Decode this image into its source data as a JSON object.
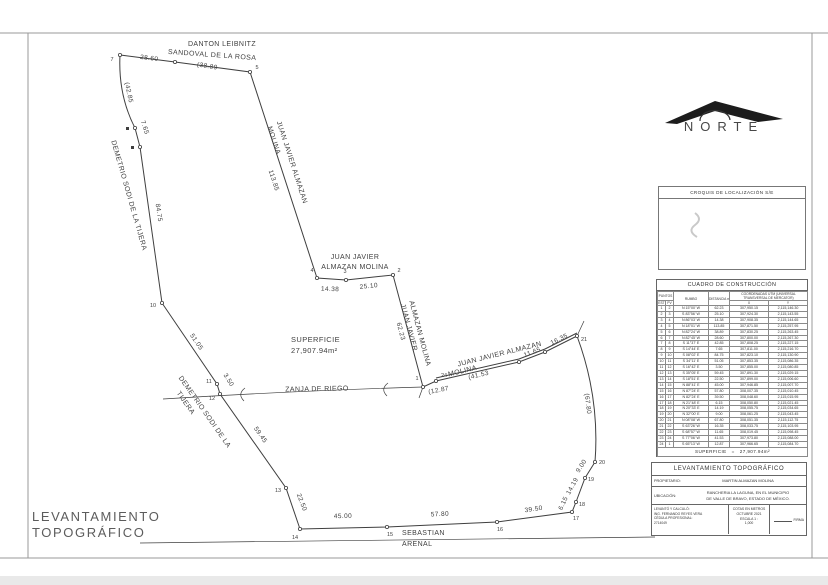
{
  "sheet_title": {
    "line1": "LEVANTAMIENTO",
    "line2": "TOPOGRÁFICO"
  },
  "north": {
    "label": "NORTE"
  },
  "croquis": {
    "title": "CROQUIS DE LOCALIZACIÓN S/E"
  },
  "drawing": {
    "superficie_label": "SUPERFICIE",
    "superficie_value": "27,907.94m²",
    "paths": [
      {
        "name": "parcel-boundary",
        "d": "M423 387 L393 275 L346 280 L317 278 L250 72 L175 62 L120 55 Q118 95 135 128 L140 147 L162 303 L217 384 L220 394 L286 488 L300 529 L387 527 L497 522 L572 512 L576 502 L585 478 L595 462 Q600 398 577 336 L545 352 L519 362 L436 381 Z",
        "w": 1
      },
      {
        "name": "boundary-double-line",
        "d": "M436 378 L519 359 L545 349 L577 333",
        "w": 1
      },
      {
        "name": "zanja-line",
        "d": "M163 399 Q290 391 423 387",
        "w": 0.7
      },
      {
        "name": "road-line",
        "d": "M140 543 L655 537",
        "w": 0.7
      },
      {
        "name": "corner-tick",
        "d": "M577 336 L584 321",
        "w": 0.7
      },
      {
        "name": "zanja-arc-mark",
        "d": "M245 388 Q237 394 244 401",
        "w": 0.7
      },
      {
        "name": "zanja-arc-mark",
        "d": "M388 383 Q380 389 387 396",
        "w": 0.7
      },
      {
        "name": "junction-tick",
        "d": "M423 387 L419 398",
        "w": 0.7
      }
    ],
    "points": [
      {
        "n": "1",
        "x": 423,
        "y": 387,
        "lx": 417,
        "ly": 380
      },
      {
        "n": "2",
        "x": 393,
        "y": 275,
        "lx": 399,
        "ly": 272
      },
      {
        "n": "3",
        "x": 346,
        "y": 280,
        "lx": 345,
        "ly": 273
      },
      {
        "n": "4",
        "x": 317,
        "y": 278,
        "lx": 312,
        "ly": 272
      },
      {
        "n": "5",
        "x": 250,
        "y": 72,
        "lx": 257,
        "ly": 69
      },
      {
        "n": "",
        "x": 175,
        "y": 62
      },
      {
        "n": "7",
        "x": 120,
        "y": 55,
        "lx": 112,
        "ly": 61
      },
      {
        "n": "",
        "x": 135,
        "y": 128,
        "sq": 1
      },
      {
        "n": "",
        "x": 140,
        "y": 147,
        "sq": 1
      },
      {
        "n": "10",
        "x": 162,
        "y": 303,
        "lx": 153,
        "ly": 307
      },
      {
        "n": "11",
        "x": 217,
        "y": 384,
        "lx": 209,
        "ly": 383
      },
      {
        "n": "12",
        "x": 220,
        "y": 394,
        "lx": 212,
        "ly": 400
      },
      {
        "n": "13",
        "x": 286,
        "y": 488,
        "lx": 278,
        "ly": 492
      },
      {
        "n": "14",
        "x": 300,
        "y": 529,
        "lx": 295,
        "ly": 539
      },
      {
        "n": "15",
        "x": 387,
        "y": 527,
        "lx": 390,
        "ly": 536
      },
      {
        "n": "16",
        "x": 497,
        "y": 522,
        "lx": 500,
        "ly": 531
      },
      {
        "n": "17",
        "x": 572,
        "y": 512,
        "lx": 576,
        "ly": 520
      },
      {
        "n": "18",
        "x": 576,
        "y": 502,
        "lx": 582,
        "ly": 506
      },
      {
        "n": "19",
        "x": 585,
        "y": 478,
        "lx": 591,
        "ly": 481
      },
      {
        "n": "20",
        "x": 595,
        "y": 462,
        "lx": 602,
        "ly": 464
      },
      {
        "n": "21",
        "x": 577,
        "y": 336,
        "lx": 584,
        "ly": 341
      },
      {
        "n": "",
        "x": 545,
        "y": 352
      },
      {
        "n": "",
        "x": 519,
        "y": 362
      },
      {
        "n": "24",
        "x": 436,
        "y": 381,
        "lx": 444,
        "ly": 377
      }
    ],
    "labels": [
      {
        "t": "62.23",
        "x": 399,
        "y": 332,
        "r": 75,
        "fs": 6.5
      },
      {
        "t": "25.10",
        "x": 369,
        "y": 288,
        "r": -6,
        "fs": 6.5
      },
      {
        "t": "14.38",
        "x": 330,
        "y": 291,
        "r": 2,
        "fs": 6.5
      },
      {
        "t": "113.85",
        "x": 272,
        "y": 181,
        "r": 72,
        "fs": 6.5
      },
      {
        "t": "(38.89",
        "x": 207,
        "y": 68,
        "r": 9,
        "fs": 6.5
      },
      {
        "t": "28.60",
        "x": 149,
        "y": 60,
        "r": 7,
        "fs": 6.5
      },
      {
        "t": "(42.85",
        "x": 127,
        "y": 93,
        "r": 78,
        "fs": 6.5
      },
      {
        "t": "7.65",
        "x": 143,
        "y": 128,
        "r": 72,
        "fs": 6.5
      },
      {
        "t": "84.75",
        "x": 157,
        "y": 213,
        "r": 81,
        "fs": 6.5
      },
      {
        "t": "51.05",
        "x": 195,
        "y": 343,
        "r": 56,
        "fs": 6.5
      },
      {
        "t": "3.50",
        "x": 227,
        "y": 381,
        "r": 58,
        "fs": 6.5
      },
      {
        "t": "59.45",
        "x": 259,
        "y": 436,
        "r": 55,
        "fs": 6.5
      },
      {
        "t": "22.50",
        "x": 300,
        "y": 503,
        "r": 69,
        "fs": 6.5
      },
      {
        "t": "45.00",
        "x": 343,
        "y": 518,
        "r": -1,
        "fs": 6.5
      },
      {
        "t": "57.80",
        "x": 440,
        "y": 516,
        "r": -3,
        "fs": 6.5
      },
      {
        "t": "39.50",
        "x": 534,
        "y": 511,
        "r": -9,
        "fs": 6.5
      },
      {
        "t": "6.15",
        "x": 565,
        "y": 504,
        "r": -65,
        "fs": 6.5
      },
      {
        "t": "14.19",
        "x": 574,
        "y": 487,
        "r": -61,
        "fs": 6.5
      },
      {
        "t": "9.00",
        "x": 583,
        "y": 467,
        "r": -57,
        "fs": 6.5
      },
      {
        "t": "(67.80",
        "x": 586,
        "y": 404,
        "r": 83,
        "fs": 6.5
      },
      {
        "t": "16.35",
        "x": 560,
        "y": 341,
        "r": -26,
        "fs": 6.5
      },
      {
        "t": "11.65",
        "x": 533,
        "y": 354,
        "r": -21,
        "fs": 6.5
      },
      {
        "t": "(41.53",
        "x": 479,
        "y": 377,
        "r": -13,
        "fs": 6.5
      },
      {
        "t": "(12.87",
        "x": 439,
        "y": 392,
        "r": -11,
        "fs": 6.5
      },
      {
        "t": "DANTON LEIBNITZ",
        "x": 222,
        "y": 46,
        "r": 0,
        "fs": 7
      },
      {
        "t": "SANDOVAL DE LA ROSA",
        "x": 212,
        "y": 57,
        "r": 4,
        "fs": 7
      },
      {
        "t": "JUAN JAVIER ALMAZAN",
        "x": 290,
        "y": 163,
        "r": 72,
        "fs": 7
      },
      {
        "t": "MOLINA",
        "x": 272,
        "y": 141,
        "r": 72,
        "fs": 7
      },
      {
        "t": "JUAN JAVIER",
        "x": 355,
        "y": 259,
        "r": 0,
        "fs": 7
      },
      {
        "t": "ALMAZAN MOLINA",
        "x": 355,
        "y": 269,
        "r": 0,
        "fs": 7
      },
      {
        "t": "JUAN JAVIER",
        "x": 407,
        "y": 328,
        "r": 75,
        "fs": 7
      },
      {
        "t": "ALMAZAN MOLINA",
        "x": 418,
        "y": 334,
        "r": 75,
        "fs": 7
      },
      {
        "t": "JUAN JAVIER ALMAZAN",
        "x": 500,
        "y": 356,
        "r": -14,
        "fs": 7
      },
      {
        "t": "MOLINA",
        "x": 463,
        "y": 373,
        "r": -14,
        "fs": 7
      },
      {
        "t": "DEMETRIO SODI DE LA TIJERA",
        "x": 127,
        "y": 196,
        "r": 74,
        "fs": 7
      },
      {
        "t": "DEMETRIO SODI DE LA",
        "x": 203,
        "y": 413,
        "r": 55,
        "fs": 7
      },
      {
        "t": "TIJERA",
        "x": 184,
        "y": 404,
        "r": 55,
        "fs": 7
      },
      {
        "t": "ZANJA DE RIEGO",
        "x": 317,
        "y": 391,
        "r": -1,
        "fs": 7
      },
      {
        "t": "SEBASTIAN",
        "x": 402,
        "y": 535,
        "r": 0,
        "fs": 7,
        "a": "start"
      },
      {
        "t": "ARENAL",
        "x": 402,
        "y": 546,
        "r": 0,
        "fs": 7,
        "a": "start"
      },
      {
        "t": "SUPERFICIE",
        "x": 291,
        "y": 342,
        "r": 0,
        "fs": 7.5,
        "a": "start"
      },
      {
        "t": "27,907.94m²",
        "x": 291,
        "y": 353,
        "r": 0,
        "fs": 7.5,
        "a": "start"
      }
    ]
  },
  "table": {
    "title": "CUADRO DE CONSTRUCCIÓN",
    "headers": {
      "punto": "PUNTOS",
      "est": "EST",
      "pv": "PV",
      "rumbo": "RUMBO",
      "dist": "DISTANCIA m.",
      "coord": "COORDENADAS UTM (UNIVERSAL TRANSVERSAL DE MERCATOR)",
      "x": "X",
      "y": "Y"
    },
    "rows": [
      [
        "1",
        "2",
        "N 15°00' W",
        "62.23",
        "307,950.15",
        "2,115,146.30"
      ],
      [
        "2",
        "3",
        "S 83°56' W",
        "25.10",
        "307,924.30",
        "2,115,143.55"
      ],
      [
        "3",
        "4",
        "N 86°03' W",
        "14.38",
        "307,908.35",
        "2,115,144.65"
      ],
      [
        "4",
        "5",
        "N 18°01' W",
        "113.85",
        "307,871.50",
        "2,115,257.95"
      ],
      [
        "5",
        "6",
        "N 82°24' W",
        "38.89",
        "307,830.25",
        "2,115,263.45"
      ],
      [
        "6",
        "7",
        "N 82°45' W",
        "28.60",
        "307,800.00",
        "2,115,267.30"
      ],
      [
        "7",
        "8",
        "S 11°37' E",
        "42.85",
        "307,808.25",
        "2,115,227.15"
      ],
      [
        "8",
        "9",
        "S 14°44' E",
        "7.65",
        "307,811.00",
        "2,115,216.70"
      ],
      [
        "9",
        "10",
        "S 08°02' E",
        "84.75",
        "307,823.10",
        "2,115,130.90"
      ],
      [
        "10",
        "11",
        "S 34°11' E",
        "51.05",
        "307,853.35",
        "2,115,086.35"
      ],
      [
        "11",
        "12",
        "S 16°42' E",
        "3.50",
        "307,855.00",
        "2,115,080.85"
      ],
      [
        "12",
        "13",
        "S 35°05' E",
        "59.45",
        "307,891.30",
        "2,115,029.15"
      ],
      [
        "13",
        "14",
        "S 18°51' E",
        "22.50",
        "307,899.00",
        "2,115,006.60"
      ],
      [
        "14",
        "15",
        "N 88°41' E",
        "45.00",
        "307,946.85",
        "2,115,007.70"
      ],
      [
        "15",
        "16",
        "N 87°24' E",
        "57.80",
        "308,007.35",
        "2,115,010.45"
      ],
      [
        "16",
        "17",
        "N 82°24' E",
        "39.50",
        "308,048.60",
        "2,115,015.95"
      ],
      [
        "17",
        "18",
        "N 21°48' E",
        "6.15",
        "308,050.80",
        "2,115,021.45"
      ],
      [
        "18",
        "19",
        "N 20°33' E",
        "14.19",
        "308,055.75",
        "2,115,034.65"
      ],
      [
        "19",
        "20",
        "N 32°00' E",
        "9.00",
        "308,061.25",
        "2,115,043.45"
      ],
      [
        "20",
        "21",
        "N 08°08' W",
        "67.80",
        "308,051.35",
        "2,115,112.75"
      ],
      [
        "21",
        "22",
        "S 63°26' W",
        "16.35",
        "308,033.75",
        "2,115,103.95"
      ],
      [
        "22",
        "23",
        "S 68°57' W",
        "11.65",
        "308,019.45",
        "2,115,098.45"
      ],
      [
        "23",
        "24",
        "S 77°06' W",
        "41.53",
        "307,973.80",
        "2,115,088.00"
      ],
      [
        "24",
        "1",
        "S 65°13' W",
        "12.87",
        "307,966.65",
        "2,115,084.70"
      ]
    ],
    "superficie_label": "SUPERFICIE",
    "superficie_eq": "=",
    "superficie_value": "27,907.94m²"
  },
  "titleblock": {
    "title": "LEVANTAMIENTO TOPOGRÁFICO",
    "propietario_label": "PROPIETARIO:",
    "propietario": "MARTIN ALMAZAN MOLINA",
    "ubicacion_label": "UBICACIÓN:",
    "ubicacion1": "RANCHERIA LA LAGUNA, EN EL MUNICIPIO",
    "ubicacion2": "DE VALLE DE BRAVO, ESTADO DE MÉXICO.",
    "levanto": [
      "LEVANTÓ Y CALCULÓ:",
      "ING. FERNANDO REYES VERA",
      "CÉDULA PROFESIONAL:",
      "2714049"
    ],
    "cotas": "COTAS EN METROS",
    "fecha": "OCTUBRE 2021",
    "escala1": "ESCALA 1 :",
    "escala2": "1,000",
    "firma": "FIRMA"
  }
}
